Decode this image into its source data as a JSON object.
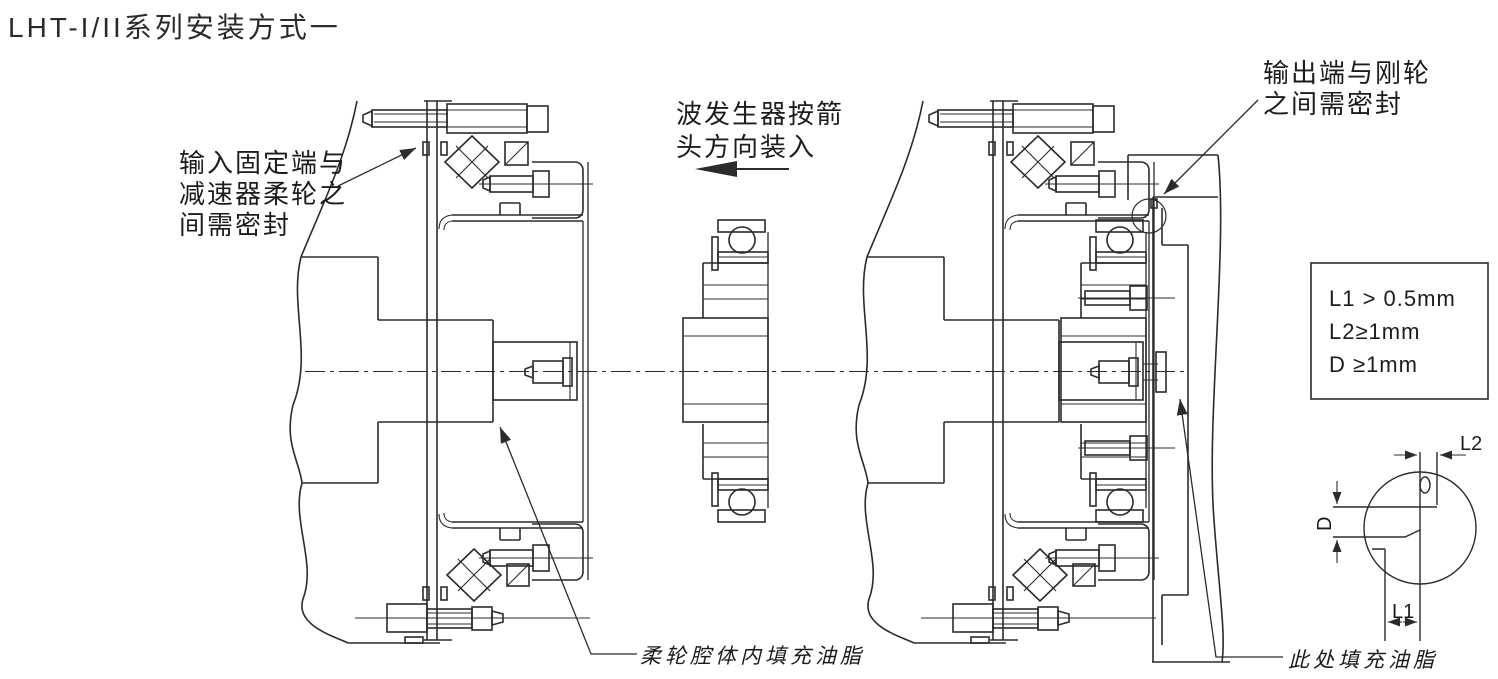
{
  "page": {
    "title": "LHT-I/II系列安装方式一"
  },
  "annotations": {
    "input_seal": "输入固定端与\n减速器柔轮之\n间需密封",
    "wave_generator": "波发生器按箭\n头方向装入",
    "output_seal": "输出端与刚轮\n之间需密封",
    "flexspline_grease": "柔轮腔体内填充油脂",
    "grease_here": "此处填充油脂"
  },
  "tolerance_box": {
    "lines": "L1 > 0.5mm\nL2≥1mm\nD ≥1mm"
  },
  "dimensions": {
    "l1": "L1",
    "l2": "L2",
    "d": "D"
  },
  "colors": {
    "line": "#2b2b2b",
    "background": "#ffffff",
    "text": "#1c1c1c"
  }
}
